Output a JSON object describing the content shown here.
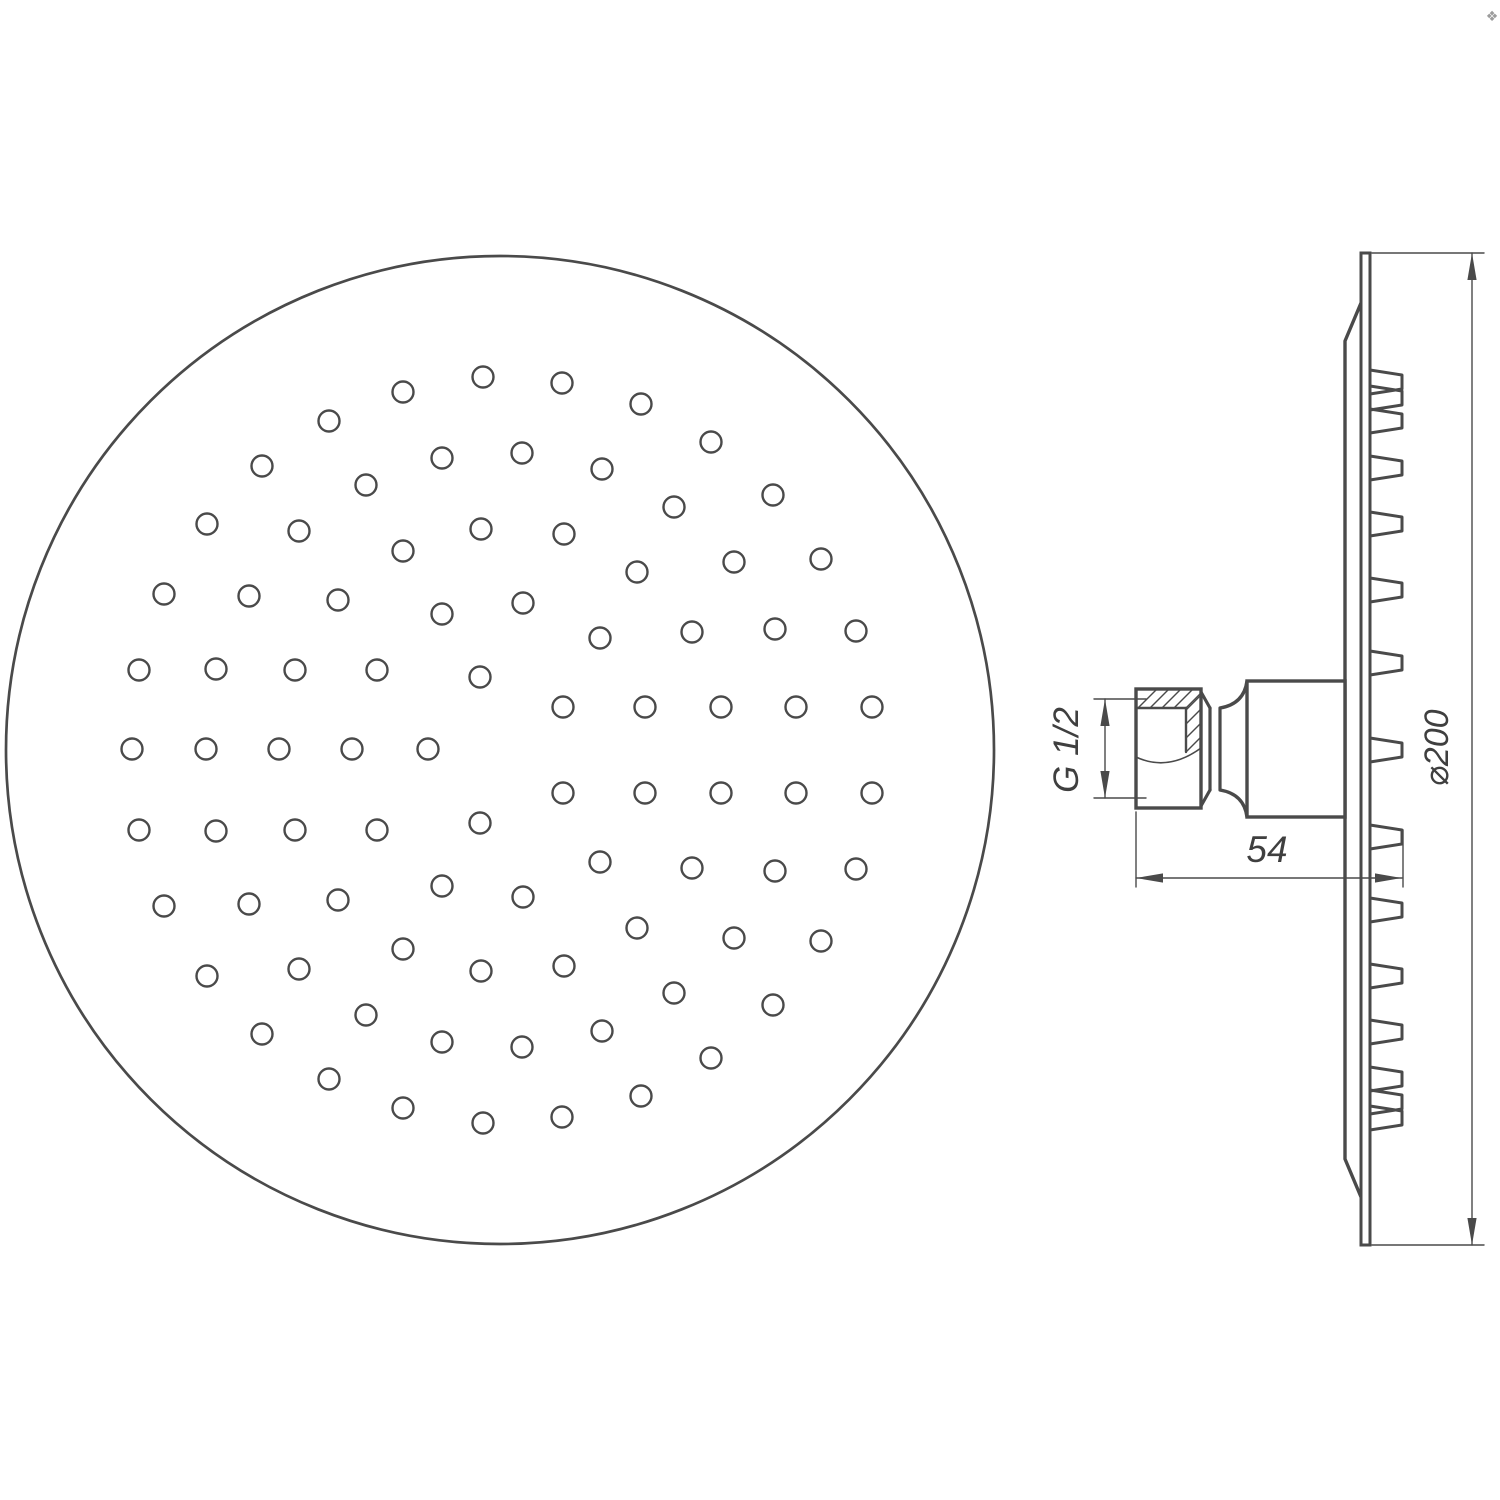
{
  "page": {
    "background": "#ffffff",
    "line_color": "#4a4a4a",
    "thin_line_color": "#4a4a4a"
  },
  "ornament": {
    "glyph": "❖",
    "color": "#9c9c9c",
    "x": 1492,
    "y": 21,
    "size": 14
  },
  "labels": {
    "thread": "G 1/2",
    "depth": "54",
    "diameter": "⌀200"
  },
  "front_view": {
    "cx": 500,
    "cy": 750,
    "radius": 494,
    "hole_radius": 10.5,
    "holes": [
      [
        483,
        377
      ],
      [
        403,
        392
      ],
      [
        329,
        421
      ],
      [
        442,
        458
      ],
      [
        262,
        466
      ],
      [
        366,
        485
      ],
      [
        207,
        524
      ],
      [
        299,
        531
      ],
      [
        481,
        529
      ],
      [
        403,
        551
      ],
      [
        164,
        594
      ],
      [
        249,
        596
      ],
      [
        338,
        600
      ],
      [
        442,
        614
      ],
      [
        139,
        670
      ],
      [
        216,
        669
      ],
      [
        295,
        670
      ],
      [
        377,
        670
      ],
      [
        480,
        677
      ],
      [
        562,
        383
      ],
      [
        641,
        404
      ],
      [
        711,
        442
      ],
      [
        522,
        453
      ],
      [
        602,
        469
      ],
      [
        773,
        495
      ],
      [
        674,
        507
      ],
      [
        564,
        534
      ],
      [
        734,
        562
      ],
      [
        821,
        559
      ],
      [
        637,
        572
      ],
      [
        523,
        603
      ],
      [
        692,
        632
      ],
      [
        775,
        629
      ],
      [
        856,
        631
      ],
      [
        600,
        638
      ],
      [
        563,
        707
      ],
      [
        645,
        707
      ],
      [
        721,
        707
      ],
      [
        796,
        707
      ],
      [
        872,
        707
      ],
      [
        132,
        749
      ],
      [
        206,
        749
      ],
      [
        279,
        749
      ],
      [
        352,
        749
      ],
      [
        428,
        749
      ],
      [
        483,
        1123
      ],
      [
        403,
        1108
      ],
      [
        329,
        1079
      ],
      [
        442,
        1042
      ],
      [
        262,
        1034
      ],
      [
        366,
        1015
      ],
      [
        207,
        976
      ],
      [
        299,
        969
      ],
      [
        481,
        971
      ],
      [
        403,
        949
      ],
      [
        164,
        906
      ],
      [
        249,
        904
      ],
      [
        338,
        900
      ],
      [
        442,
        886
      ],
      [
        139,
        830
      ],
      [
        216,
        831
      ],
      [
        295,
        830
      ],
      [
        377,
        830
      ],
      [
        480,
        823
      ],
      [
        562,
        1117
      ],
      [
        641,
        1096
      ],
      [
        711,
        1058
      ],
      [
        522,
        1047
      ],
      [
        602,
        1031
      ],
      [
        773,
        1005
      ],
      [
        674,
        993
      ],
      [
        564,
        966
      ],
      [
        734,
        938
      ],
      [
        821,
        941
      ],
      [
        637,
        928
      ],
      [
        523,
        897
      ],
      [
        692,
        868
      ],
      [
        775,
        871
      ],
      [
        856,
        869
      ],
      [
        600,
        862
      ],
      [
        563,
        793
      ],
      [
        645,
        793
      ],
      [
        721,
        793
      ],
      [
        796,
        793
      ],
      [
        872,
        793
      ]
    ]
  },
  "side_view": {
    "plate": {
      "x1": 1361,
      "x2": 1370,
      "top": 253,
      "bottom": 1245
    },
    "shell": {
      "x": 1345,
      "top_start_y": 303,
      "top_end_y": 341,
      "bottom_start_y": 1159,
      "bottom_end_y": 1197
    },
    "nozzles": {
      "base_x": 1370,
      "tip_x": 1402,
      "base_half_height": 12,
      "tip_half_height": 7,
      "centers": [
        382,
        398,
        421,
        468,
        524,
        590,
        663,
        750,
        837,
        910,
        976,
        1032,
        1079,
        1102,
        1118
      ]
    },
    "mount_block": {
      "x": 1247,
      "y": 681,
      "w": 98,
      "h": 136
    },
    "nut": {
      "x": 1136,
      "y": 689,
      "w": 65,
      "h": 119,
      "inner_line_y": 708,
      "inner_vert_x": 1186,
      "inner_vert_y2": 752,
      "hatch": [
        [
          1138,
          708,
          1157,
          689
        ],
        [
          1150,
          708,
          1169,
          689
        ],
        [
          1162,
          708,
          1181,
          689
        ],
        [
          1174,
          708,
          1193,
          689
        ],
        [
          1186,
          708,
          1201,
          693
        ],
        [
          1186,
          710,
          1201,
          695
        ],
        [
          1186,
          724,
          1201,
          709
        ],
        [
          1186,
          738,
          1201,
          723
        ],
        [
          1186,
          752,
          1201,
          737
        ]
      ],
      "relief_curve": [
        1136,
        757,
        1168,
        772,
        1201,
        748
      ]
    },
    "neck": {
      "cone_top": [
        1201,
        692,
        1210,
        708
      ],
      "cone_bottom": [
        1201,
        806,
        1210,
        790
      ],
      "ring_x1": 1210,
      "ring_x2": 1220,
      "ring_y1": 708,
      "ring_y2": 790,
      "flare_top": [
        1220,
        708,
        1244,
        704,
        1247,
        681
      ],
      "flare_bottom": [
        1220,
        790,
        1244,
        794,
        1247,
        817
      ]
    },
    "dims": {
      "thread": {
        "line_x": 1105,
        "y1": 699,
        "y2": 798,
        "ext_x1": 1094,
        "ext_x2": 1146,
        "label_x": 1078,
        "label_y": 750,
        "font_size": 35
      },
      "depth": {
        "line_y": 878,
        "x1": 1136,
        "x2": 1402,
        "ext_left_x": 1136,
        "ext_left_y1": 812,
        "ext_left_y2": 887,
        "ext_right_x": 1403,
        "ext_right_y1": 830,
        "ext_right_y2": 887,
        "label_x": 1267,
        "label_y": 862,
        "font_size": 37
      },
      "diameter": {
        "line_x": 1472,
        "y1": 253,
        "y2": 1245,
        "ext_y1": 253,
        "ext_y2": 1245,
        "ext_x1": 1372,
        "ext_x2": 1484,
        "label_x": 1448,
        "label_y": 748,
        "font_size": 34
      }
    }
  }
}
